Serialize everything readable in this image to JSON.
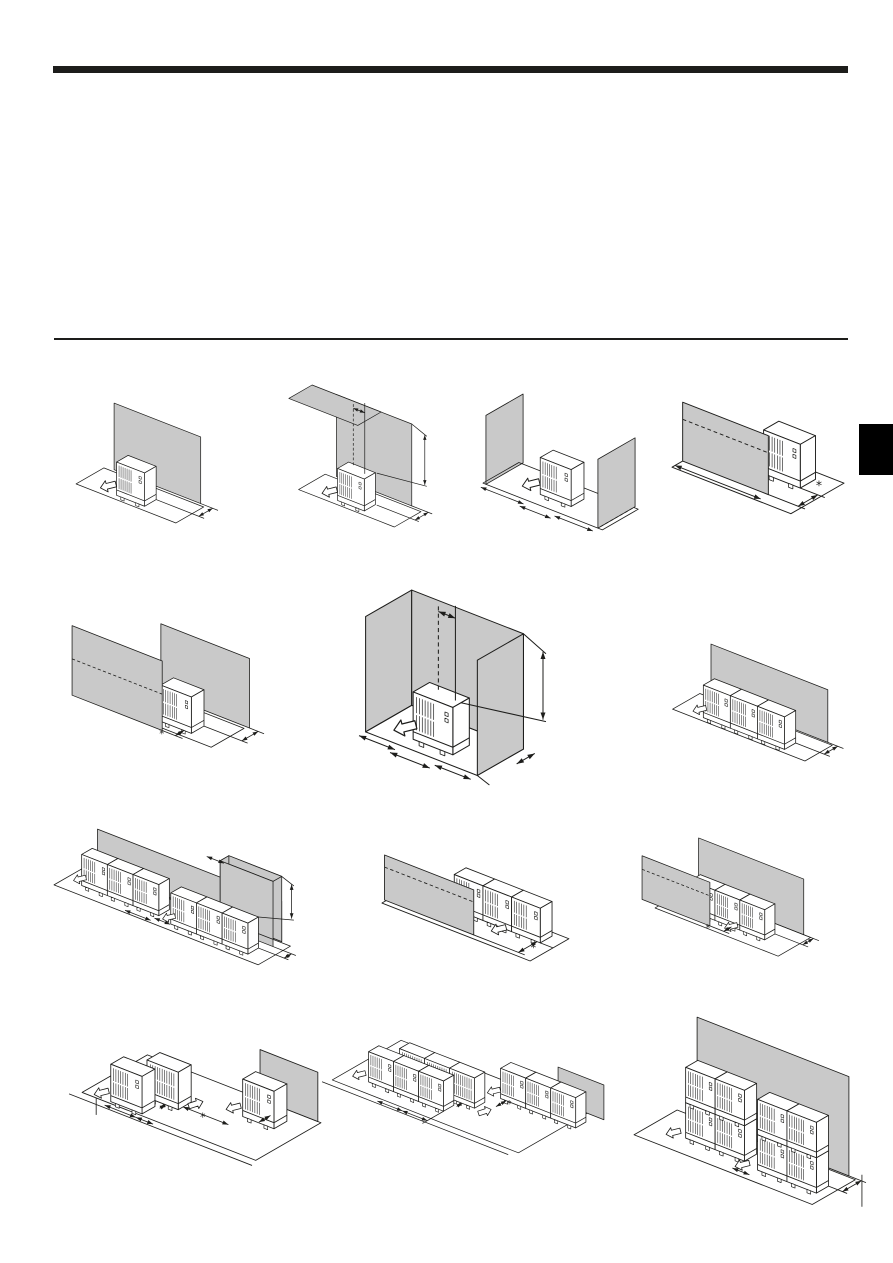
{
  "page": {
    "type": "installation-manual-page",
    "background": "#ffffff",
    "visible_text": "none (diagram-only page)"
  },
  "header_rule": {
    "color": "#1d1d1b"
  },
  "section_rule": {
    "color": "#1d1d1b"
  },
  "side_tab": {
    "color": "#000000"
  },
  "palette": {
    "wall_fill": "#c9c9c9",
    "line": "#1d1d1b",
    "unit_fill": "#ffffff",
    "grille": "#2a2a2a"
  },
  "annotation": {
    "asterisk": "*"
  },
  "diagrams": [
    {
      "name": "single-unit-wall-behind",
      "label": "Single outdoor unit with wall behind, rear clearance dimension",
      "unit_count": 1,
      "walls": [
        "behind"
      ],
      "has_asterisk": false,
      "airflow_arrows": 1
    },
    {
      "name": "single-unit-wall-behind-obstacle-above",
      "label": "Single outdoor unit with tall wall behind and obstacle above, height and top clearance dimensions",
      "unit_count": 1,
      "walls": [
        "behind",
        "above"
      ],
      "has_asterisk": false,
      "airflow_arrows": 1
    },
    {
      "name": "single-unit-walls-both-sides",
      "label": "Single outdoor unit with walls on both sides, side clearance dimensions",
      "unit_count": 1,
      "walls": [
        "left",
        "right"
      ],
      "has_asterisk": false,
      "airflow_arrows": 1
    },
    {
      "name": "single-unit-wall-front",
      "label": "Single outdoor unit with wall in front of air outlet, front clearance dimension marked with asterisk",
      "unit_count": 1,
      "walls": [
        "front"
      ],
      "has_asterisk": true,
      "airflow_arrows": 1
    },
    {
      "name": "single-unit-walls-front-and-back",
      "label": "Single outdoor unit between parallel front and back walls, clearances with asterisk",
      "unit_count": 1,
      "walls": [
        "front",
        "behind"
      ],
      "has_asterisk": true,
      "airflow_arrows": 1
    },
    {
      "name": "single-unit-three-sided-enclosure",
      "label": "Single outdoor unit inside three-sided tall enclosure, height and side clearance dimensions",
      "unit_count": 1,
      "walls": [
        "left",
        "behind",
        "right"
      ],
      "has_asterisk": false,
      "airflow_arrows": 1
    },
    {
      "name": "multi-unit-row-wall-behind",
      "label": "Row of three outdoor units with wall behind, rear clearance dimension",
      "unit_count": 3,
      "walls": [
        "behind"
      ],
      "has_asterisk": false,
      "airflow_arrows": 1
    },
    {
      "name": "multi-unit-rows-wall-behind-tall-obstacle",
      "label": "Two rows of three outdoor units along a wall with taller wall section, gap and height dimensions",
      "unit_count": 6,
      "walls": [
        "behind",
        "tall-section"
      ],
      "has_asterisk": false,
      "airflow_arrows": 2
    },
    {
      "name": "multi-unit-row-wall-front",
      "label": "Row of three outdoor units with wall in front of air outlets, clearance with asterisk",
      "unit_count": 3,
      "walls": [
        "front"
      ],
      "has_asterisk": true,
      "airflow_arrows": 1
    },
    {
      "name": "multi-unit-row-walls-front-and-back",
      "label": "Row of three outdoor units between front and back walls, clearances with asterisk",
      "unit_count": 3,
      "walls": [
        "front",
        "behind"
      ],
      "has_asterisk": true,
      "airflow_arrows": 1
    },
    {
      "name": "units-facing-each-other-single",
      "label": "Outdoor units installed facing each other plus unit at wall, separation dimensions with asterisk",
      "unit_count": 3,
      "walls": [
        "behind-right"
      ],
      "has_asterisk": true,
      "airflow_arrows": 3
    },
    {
      "name": "units-facing-each-other-rows",
      "label": "Rows of outdoor units facing each other plus row at wall, separation dimensions with asterisk",
      "unit_count": 9,
      "walls": [
        "behind-right"
      ],
      "has_asterisk": true,
      "airflow_arrows": 3
    },
    {
      "name": "stacked-units-wall-behind",
      "label": "Stacked outdoor units (two high, two wide, two groups) with tall wall behind, gap and rear clearance dimensions",
      "unit_count": 8,
      "walls": [
        "behind"
      ],
      "has_asterisk": false,
      "airflow_arrows": 2
    }
  ]
}
